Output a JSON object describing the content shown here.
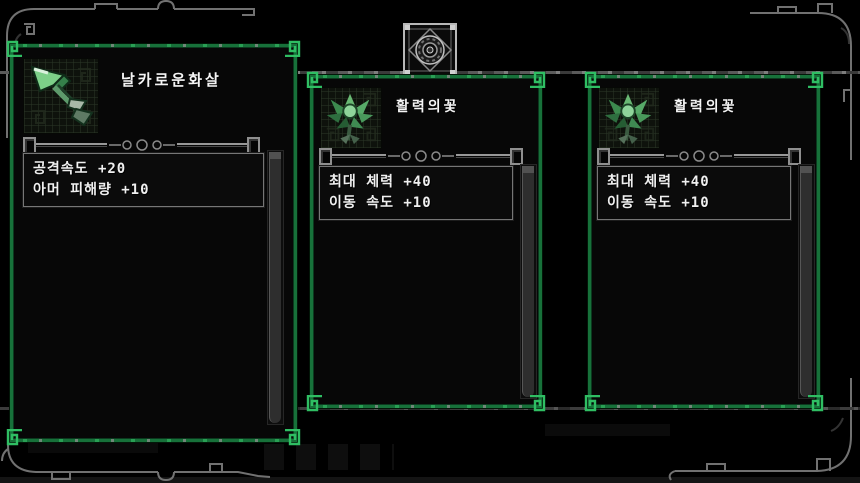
{
  "screen": {
    "width": 860,
    "height": 483,
    "background": "#000000"
  },
  "emblem": {
    "name": "ornate-medallion"
  },
  "dividers": {
    "top_y": 71,
    "bottom_y": 407
  },
  "colors": {
    "panel_background": "#070707",
    "panel_border_green": "#17713a",
    "panel_border_bright_green": "#2fbe63",
    "frame_gray": "#787878",
    "inner_divider_gray": "#8a8a8a",
    "text": "#f2f2f2",
    "scrollbar_thumb": "#2e2e2e",
    "item_green": "#6cc47c"
  },
  "panels": [
    {
      "id": "sharp-arrow",
      "title": "날카로운화살",
      "icon": "arrow-icon",
      "stats": [
        "공격속도 +20",
        "아머 피해량 +10"
      ]
    },
    {
      "id": "vitality-flower-1",
      "title": "활력의꽃",
      "icon": "flower-icon",
      "stats": [
        "최대 체력 +40",
        "이동 속도 +10"
      ]
    },
    {
      "id": "vitality-flower-2",
      "title": "활력의꽃",
      "icon": "flower-icon",
      "stats": [
        "최대 체력 +40",
        "이동 속도 +10"
      ]
    }
  ]
}
